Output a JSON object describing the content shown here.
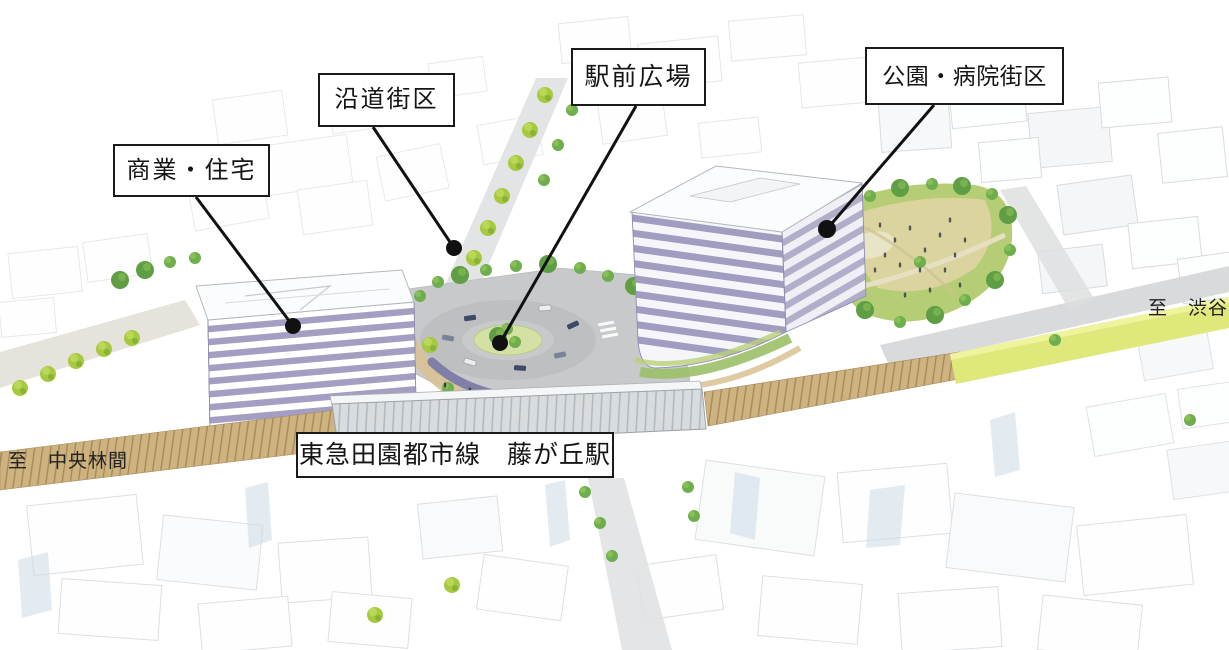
{
  "callouts": [
    {
      "id": "commercial-residential",
      "label": "商業・住宅"
    },
    {
      "id": "roadside-block",
      "label": "沿道街区"
    },
    {
      "id": "station-plaza",
      "label": "駅前広場"
    },
    {
      "id": "park-hospital-block",
      "label": "公園・病院街区"
    }
  ],
  "railway": {
    "station_label": "東急田園都市線　藤が丘駅"
  },
  "directions": {
    "to_shibuya": "至　渋谷",
    "to_chuo_rinkan": "至　中央林間"
  },
  "colors": {
    "label_border": "#1a1a1a",
    "label_background": "#ffffff",
    "leader_line": "#111111",
    "building_facade_stripe": "#a49fc2",
    "building_roof": "#fbfcfd",
    "tree_bright_green": "#a6c93f",
    "tree_dark_green": "#5f9e45",
    "park_lawn_tan": "#dcd49e",
    "park_green": "#b5cd74",
    "rail_track_tan": "#cdb37f",
    "rail_corridor_yellow": "#dfe87a",
    "station_canopy_gray": "#d9dcde",
    "plaza_asphalt": "#c7c9cb",
    "plaza_promenade_tan": "#d9c193",
    "canopy_purple": "#7372a4",
    "road_gray": "#dfe1e2",
    "sketch_line": "#bfc6cb"
  }
}
